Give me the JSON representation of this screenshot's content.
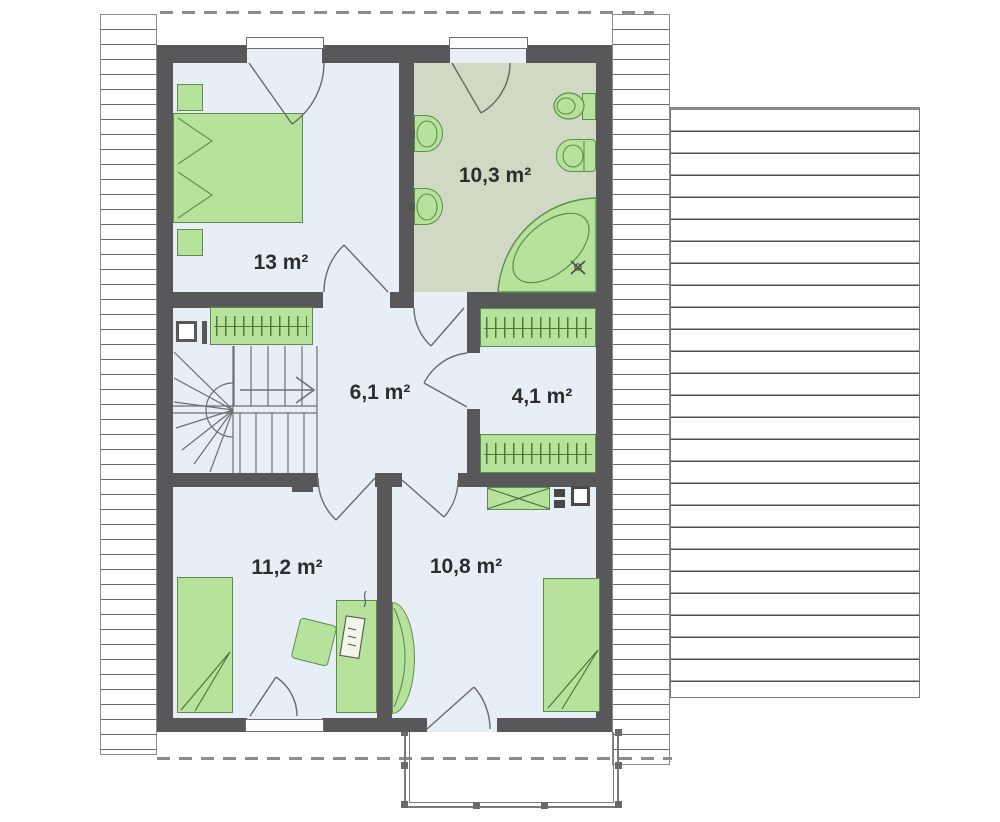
{
  "plan": {
    "rooms": [
      {
        "id": "bedroom-top",
        "area": "13 m²"
      },
      {
        "id": "bathroom",
        "area": "10,3 m²"
      },
      {
        "id": "hallway",
        "area": "6,1 m²"
      },
      {
        "id": "walk-in-closet",
        "area": "4,1 m²"
      },
      {
        "id": "bedroom-bottom-left",
        "area": "11,2 m²"
      },
      {
        "id": "bedroom-bottom-right",
        "area": "10,8 m²"
      }
    ],
    "colors": {
      "wall": "#58585b",
      "floor": "#e8eef6",
      "bathroom_floor": "#cfd9c4",
      "furniture": "#b6e29c",
      "furniture_border": "#5f8c4e",
      "line": "#6a6a6a"
    }
  }
}
